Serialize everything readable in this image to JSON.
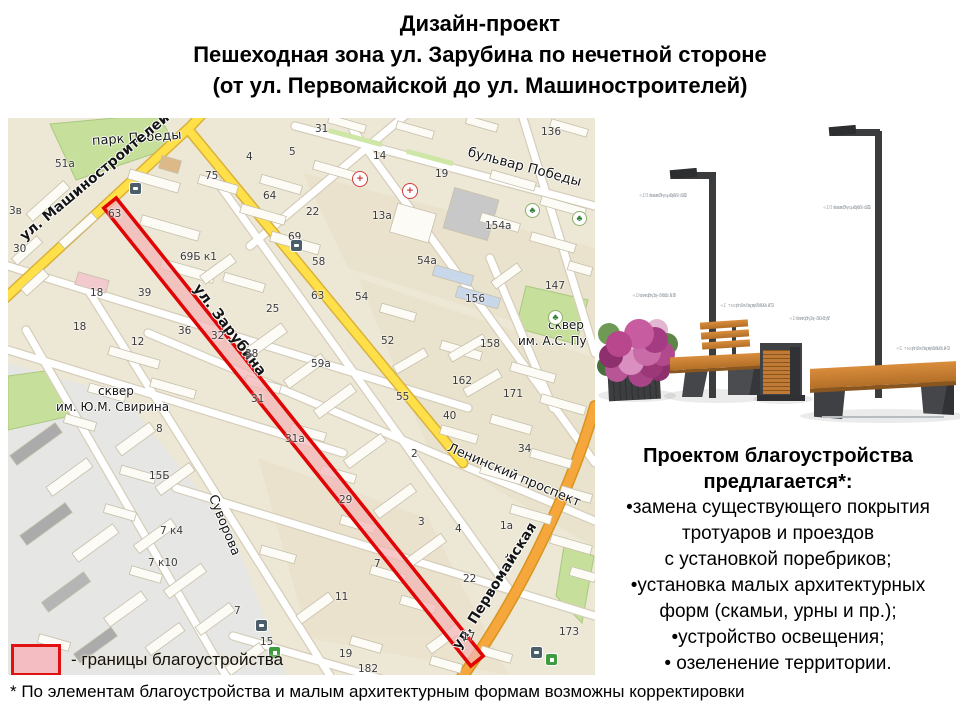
{
  "title": {
    "line1": "Дизайн-проект",
    "line2": "Пешеходная зона ул. Зарубина по нечетной стороне",
    "line3": "(от ул. Первомайской до ул. Машиностроителей)"
  },
  "legend": {
    "label": "- границы благоустройства",
    "swatch_fill": "#f3bdc2",
    "swatch_border": "#e01212"
  },
  "footnote": "* По элементам благоустройства и малым архитектурным формам возможны корректировки",
  "proposal": {
    "heading_line1": "Проектом благоустройства",
    "heading_line2": "предлагается*:",
    "lines": [
      "•замена существующего покрытия",
      "тротуаров и проездов",
      "с установкой поребриков;",
      "•установка малых архитектурных",
      "форм (скамьи, урны и пр.);",
      "•устройство освещения;",
      "• озеленение территории."
    ]
  },
  "map": {
    "colors": {
      "background": "#ede7d6",
      "road_yellow": "#ffe049",
      "road_orange": "#f5a73b",
      "park_green": "#c6e09b",
      "boundary_red": "#e00404",
      "boundary_fill": "#f3b6b6"
    },
    "street_labels": [
      {
        "t": "парк Победы",
        "x": 84,
        "y": 16,
        "r": -4,
        "s": 13,
        "b": 0
      },
      {
        "t": "ул. Машиностроителей",
        "x": 14,
        "y": 112,
        "r": -40,
        "s": 14,
        "b": 1
      },
      {
        "t": "бульвар Победы",
        "x": 460,
        "y": 26,
        "r": 15,
        "s": 13.5,
        "b": 0
      },
      {
        "t": "ул. Зарубина",
        "x": 188,
        "y": 160,
        "r": 53,
        "s": 14.5,
        "b": 1
      },
      {
        "t": "сквер",
        "x": 90,
        "y": 266,
        "r": 0,
        "s": 12,
        "b": 0
      },
      {
        "t": "им. Ю.М. Свирина",
        "x": 48,
        "y": 282,
        "r": 0,
        "s": 12,
        "b": 0
      },
      {
        "t": "Ленинский проспект",
        "x": 440,
        "y": 322,
        "r": 23,
        "s": 13,
        "b": 0
      },
      {
        "t": "Суворова",
        "x": 204,
        "y": 370,
        "r": 68,
        "s": 13,
        "b": 0
      },
      {
        "t": "ул. Первомайская",
        "x": 448,
        "y": 522,
        "r": -58,
        "s": 14,
        "b": 1
      },
      {
        "t": "сквер",
        "x": 540,
        "y": 200,
        "r": 0,
        "s": 12,
        "b": 0
      },
      {
        "t": "им. А.С. Пу",
        "x": 510,
        "y": 216,
        "r": 0,
        "s": 12,
        "b": 0
      }
    ],
    "house_numbers": [
      [
        47,
        40,
        "51a"
      ],
      [
        197,
        52,
        "75"
      ],
      [
        238,
        33,
        "4"
      ],
      [
        281,
        28,
        "5"
      ],
      [
        255,
        72,
        "64"
      ],
      [
        1,
        87,
        "3в"
      ],
      [
        5,
        125,
        "30"
      ],
      [
        100,
        90,
        "63"
      ],
      [
        172,
        133,
        "69Б к1"
      ],
      [
        280,
        113,
        "69"
      ],
      [
        82,
        169,
        "18"
      ],
      [
        130,
        169,
        "39"
      ],
      [
        258,
        185,
        "25"
      ],
      [
        65,
        203,
        "18"
      ],
      [
        170,
        207,
        "36"
      ],
      [
        123,
        218,
        "12"
      ],
      [
        203,
        212,
        "32"
      ],
      [
        237,
        230,
        "38"
      ],
      [
        303,
        172,
        "63"
      ],
      [
        347,
        173,
        "54"
      ],
      [
        373,
        217,
        "52"
      ],
      [
        303,
        240,
        "59a"
      ],
      [
        388,
        273,
        "55"
      ],
      [
        148,
        305,
        "8"
      ],
      [
        141,
        352,
        "15Б"
      ],
      [
        435,
        292,
        "40"
      ],
      [
        403,
        330,
        "2"
      ],
      [
        510,
        325,
        "34"
      ],
      [
        495,
        270,
        "171"
      ],
      [
        537,
        162,
        "147"
      ],
      [
        457,
        175,
        "156"
      ],
      [
        472,
        220,
        "158"
      ],
      [
        444,
        257,
        "162"
      ],
      [
        410,
        398,
        "3"
      ],
      [
        447,
        405,
        "4"
      ],
      [
        492,
        402,
        "1a"
      ],
      [
        455,
        455,
        "22"
      ],
      [
        252,
        518,
        "15"
      ],
      [
        331,
        530,
        "19"
      ],
      [
        350,
        545,
        "182"
      ],
      [
        152,
        407,
        "7 к4"
      ],
      [
        140,
        439,
        "7 к10"
      ],
      [
        226,
        487,
        "7"
      ],
      [
        327,
        473,
        "11"
      ],
      [
        331,
        376,
        "29"
      ],
      [
        366,
        440,
        "7"
      ],
      [
        551,
        508,
        "173"
      ],
      [
        533,
        8,
        "136"
      ],
      [
        427,
        50,
        "19"
      ],
      [
        365,
        32,
        "14"
      ],
      [
        307,
        5,
        "31"
      ],
      [
        364,
        92,
        "13a"
      ],
      [
        298,
        88,
        "22"
      ],
      [
        409,
        137,
        "54a"
      ],
      [
        477,
        102,
        "154a"
      ],
      [
        304,
        138,
        "58"
      ],
      [
        454,
        513,
        "17"
      ],
      [
        243,
        275,
        "31"
      ],
      [
        277,
        315,
        "31a"
      ]
    ],
    "icons": [
      {
        "type": "hospital",
        "x": 394,
        "y": 65
      },
      {
        "type": "pharmacy",
        "x": 344,
        "y": 53
      },
      {
        "type": "tree",
        "x": 517,
        "y": 85
      },
      {
        "type": "tree",
        "x": 564,
        "y": 93
      },
      {
        "type": "tree",
        "x": 540,
        "y": 192
      },
      {
        "type": "bus",
        "x": 121,
        "y": 64
      },
      {
        "type": "bus",
        "x": 282,
        "y": 121
      },
      {
        "type": "bus",
        "x": 247,
        "y": 501
      },
      {
        "type": "bus",
        "x": 522,
        "y": 528
      },
      {
        "type": "fuel",
        "x": 260,
        "y": 528
      },
      {
        "type": "fuel",
        "x": 537,
        "y": 535
      }
    ]
  },
  "furniture": {
    "annotations": [
      {
        "name": "Фонарь «Свая 01»",
        "price": "22 700 рублей",
        "x": 25,
        "y": 76
      },
      {
        "name": "Фонарь «Свая 01»",
        "price": "22 700 рублей",
        "x": 209,
        "y": 88
      },
      {
        "name": "Вазон «Стрит 1»",
        "price": "17 385 рублей",
        "x": 14,
        "y": 176
      },
      {
        "name": "Скамейка «Стрит 1»",
        "price": "25 937 рублей",
        "x": 112,
        "y": 186
      },
      {
        "name": "Урна «Стрит 1»",
        "price": "9 505 рублей",
        "x": 168,
        "y": 199
      },
      {
        "name": "Скамейка «Стрит 2»",
        "price": "24 520 рублей",
        "x": 288,
        "y": 229
      }
    ]
  }
}
